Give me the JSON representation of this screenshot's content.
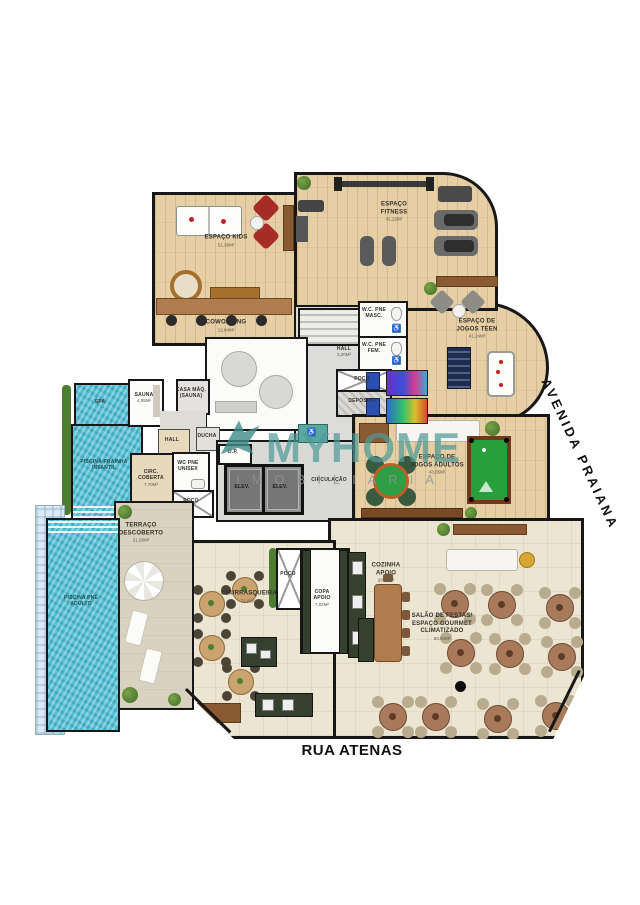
{
  "watermark": {
    "brand": "MYHOME",
    "sub": "IMOBILIÁRIA",
    "color": "#4F9A97"
  },
  "streets": {
    "bottom": "RUA ATENAS",
    "right": "AVENIDA PRAIANA"
  },
  "icons": {
    "accessibility": "♿"
  },
  "rooms": {
    "espaco_kids": {
      "label": "ESPAÇO KIDS",
      "area": "51,36m²"
    },
    "coworking": {
      "label": "COWORKING",
      "area": "12,84m²"
    },
    "espaco_fitness": {
      "label": "ESPAÇO FITNESS",
      "area": "41,22m²"
    },
    "jogos_teen": {
      "label": "ESPAÇO DE JOGOS TEEN",
      "area": "41,24m²"
    },
    "wc_pne_masc": {
      "label": "W.C. PNE MASC.",
      "area": "4,17m²"
    },
    "wc_pne_fem": {
      "label": "W.C. PNE FEM.",
      "area": "4,17m²"
    },
    "hall_core": {
      "label": "HALL",
      "area": "3,20m²"
    },
    "poco_core": {
      "label": "POÇO",
      "area": "2,40m²"
    },
    "deposito": {
      "label": "DEPÓSITO",
      "area": "3,30m²"
    },
    "spa": {
      "label": "SPA"
    },
    "sauna": {
      "label": "SAUNA",
      "area": "4,55m²"
    },
    "casa_maq": {
      "label": "CASA MÁQ. (SAUNA)",
      "area": "1,96m²"
    },
    "hall_sauna": {
      "label": "HALL",
      "area": "1,79m²"
    },
    "ducha": {
      "label": "DUCHA"
    },
    "circ_coberta": {
      "label": "CIRC. COBERTA",
      "area": "7,70m²"
    },
    "wc_pne_unisex": {
      "label": "WC PNE UNISEX",
      "area": "3,72m²"
    },
    "poco_sauna": {
      "label": "POÇO"
    },
    "dp": {
      "label": "D.P."
    },
    "elev": {
      "label": "ELEV.",
      "area": "3,06m²"
    },
    "circulacao": {
      "label": "CIRCULAÇÃO",
      "area": "29,14m²"
    },
    "piscina_prainha": {
      "label": "PISCINA PRAINHA INFANTIL",
      "area": "15,10m²"
    },
    "piscina_pne": {
      "label": "PISCINA PNE ADULTO",
      "area": "32,17m²"
    },
    "terraco": {
      "label": "TERRAÇO DESCOBERTO",
      "area": "21,56m²"
    },
    "jogos_adultos": {
      "label": "ESPAÇO DE JOGOS ADULTOS",
      "area": "43,05m²"
    },
    "churrasqueira": {
      "label": "CHURRASQUEIRA",
      "area": "71,82m²"
    },
    "poco_churras": {
      "label": "POÇO"
    },
    "copa_apoio": {
      "label": "COPA APOIO",
      "area": "7,02m²"
    },
    "cozinha_apoio": {
      "label": "COZINHA APOIO",
      "area": "29,80m²"
    },
    "salao": {
      "label": "SALÃO DE FESTAS/ ESPAÇO GOURMET CLIMATIZADO",
      "area": "83,40m²"
    }
  }
}
